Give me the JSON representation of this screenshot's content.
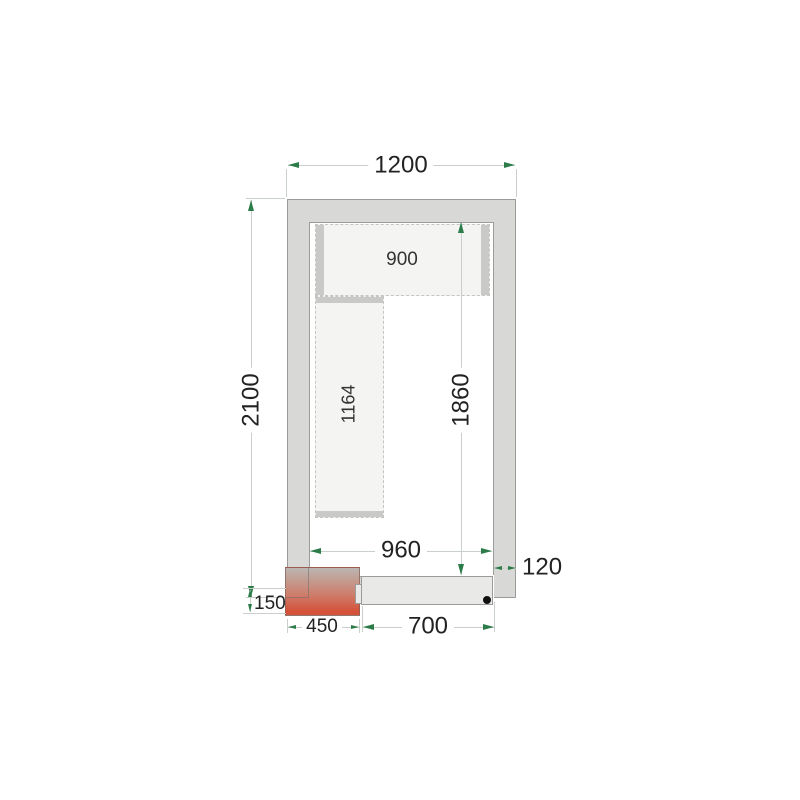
{
  "diagram": {
    "type": "cold-room-floor-plan-drawing",
    "labels": {
      "outer_width": "1200",
      "outer_height": "2100",
      "inner_width": "960",
      "inner_height": "1860",
      "wall_thickness": "120",
      "door_width": "700",
      "unit_width": "450",
      "unit_protrusion": "150",
      "shelf_top_length": "900",
      "shelf_left_length": "1164"
    },
    "colors": {
      "wall_fill": "#d8d8d6",
      "wall_border": "#9b9b99",
      "interior_fill": "#ffffff",
      "shelf_fill": "#f4f4f3",
      "shelf_border": "#c5c5c2",
      "shelf_cap": "#c9c9c7",
      "dim_line": "#c9cfca",
      "dim_arrow": "#2c7c4a",
      "dim_text": "#222222",
      "unit_top": "#bab6b1",
      "unit_mid": "#cd7f6d",
      "unit_bottom": "#d5523a",
      "door_fill": "#e9e9e8",
      "door_border": "#9b9b99",
      "handle_dot": "#111111",
      "background": "#ffffff"
    }
  }
}
